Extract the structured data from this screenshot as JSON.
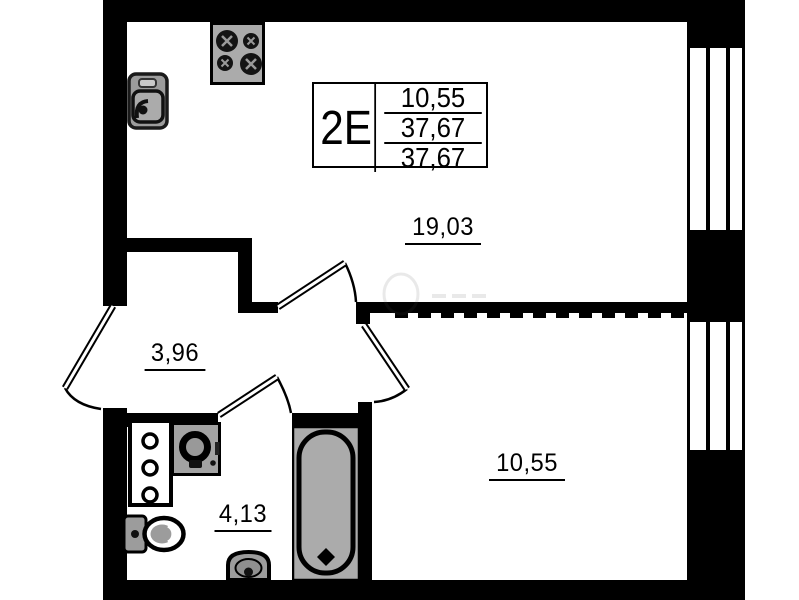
{
  "plan": {
    "unit_label": "2E",
    "info_table": {
      "rows": [
        "10,55",
        "37,67",
        "37,67"
      ]
    },
    "rooms": {
      "living": {
        "area": "19,03"
      },
      "hall": {
        "area": "3,96"
      },
      "bath": {
        "area": "4,13"
      },
      "bedroom": {
        "area": "10,55"
      }
    },
    "icons": [
      "stove-icon",
      "kitchen-sink-icon",
      "bathroom-cabinet-icon",
      "washing-machine-icon",
      "toilet-icon",
      "washbasin-icon",
      "bathtub-icon",
      "window-icon"
    ],
    "colors": {
      "wall": "#000000",
      "fixture_fill": "#a8a8a8",
      "background": "#ffffff"
    }
  }
}
